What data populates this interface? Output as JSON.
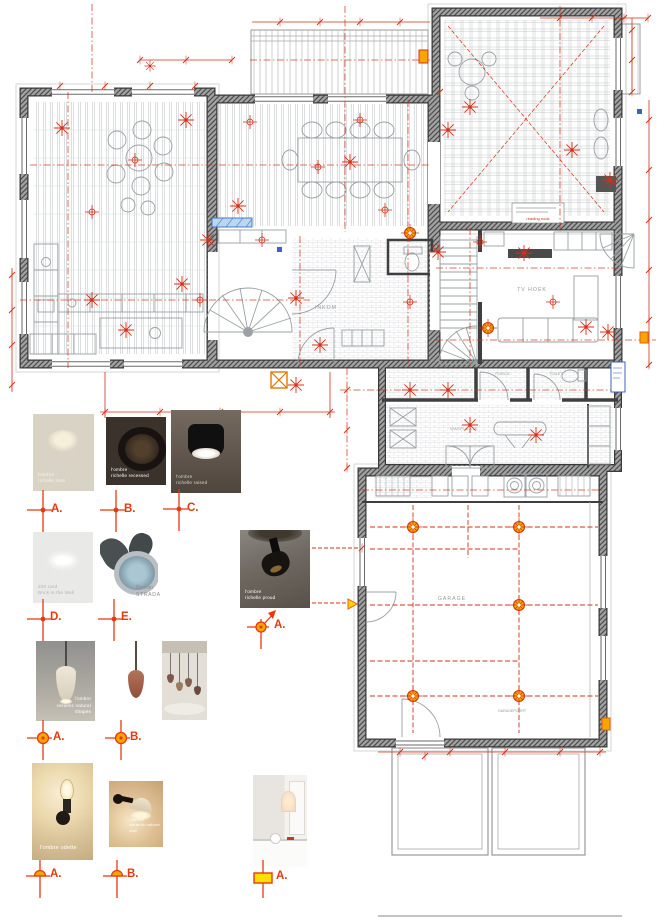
{
  "plan": {
    "rooms": {
      "inkom": "INKOM",
      "tv_hoek": "TV HOEK",
      "porch": "PORCH.",
      "toilet": "TOILET",
      "wasplaats": "WASPLAATS",
      "garage": "GARAGE",
      "garagepoort": "GARAGEPOORT"
    },
    "notes": {
      "reading_nook": "reading nook"
    },
    "colors": {
      "annotation_red": "#d43018",
      "fixture_orange": "#f7a600",
      "window_blue": "#4a7fd0",
      "wall_gray": "#3f3f3f"
    }
  },
  "legend": {
    "recessed": [
      {
        "letter": "A.",
        "line1": "l'ombre",
        "line2": "richelle zero"
      },
      {
        "letter": "B.",
        "line1": "l'ombre",
        "line2": "richelle recessed"
      },
      {
        "letter": "C.",
        "line1": "l'ombre",
        "line2": "richelle raised"
      }
    ],
    "wall_recessed": [
      {
        "letter": "D.",
        "line1": "200 card",
        "line2": "Brick in the Wall"
      },
      {
        "letter": "E.",
        "line1": "Bertran",
        "line2": "STRADA"
      }
    ],
    "proud": {
      "letter": "A.",
      "line1": "l'ombre",
      "line2": "richelle proud"
    },
    "pendants": [
      {
        "letter": "A.",
        "line1": "l'ombre",
        "line2": "ceramic natural",
        "line3": "shapes"
      },
      {
        "letter": "B.",
        "line1": "l'ombre",
        "line2": "charlize"
      }
    ],
    "wall_lights": [
      {
        "letter": "A.",
        "line1": "l'ombre odette"
      },
      {
        "letter": "B.",
        "line1": "l'ombre",
        "line2": "ceramic naturel",
        "line3": "wall"
      }
    ],
    "niche": {
      "letter": "A."
    }
  }
}
